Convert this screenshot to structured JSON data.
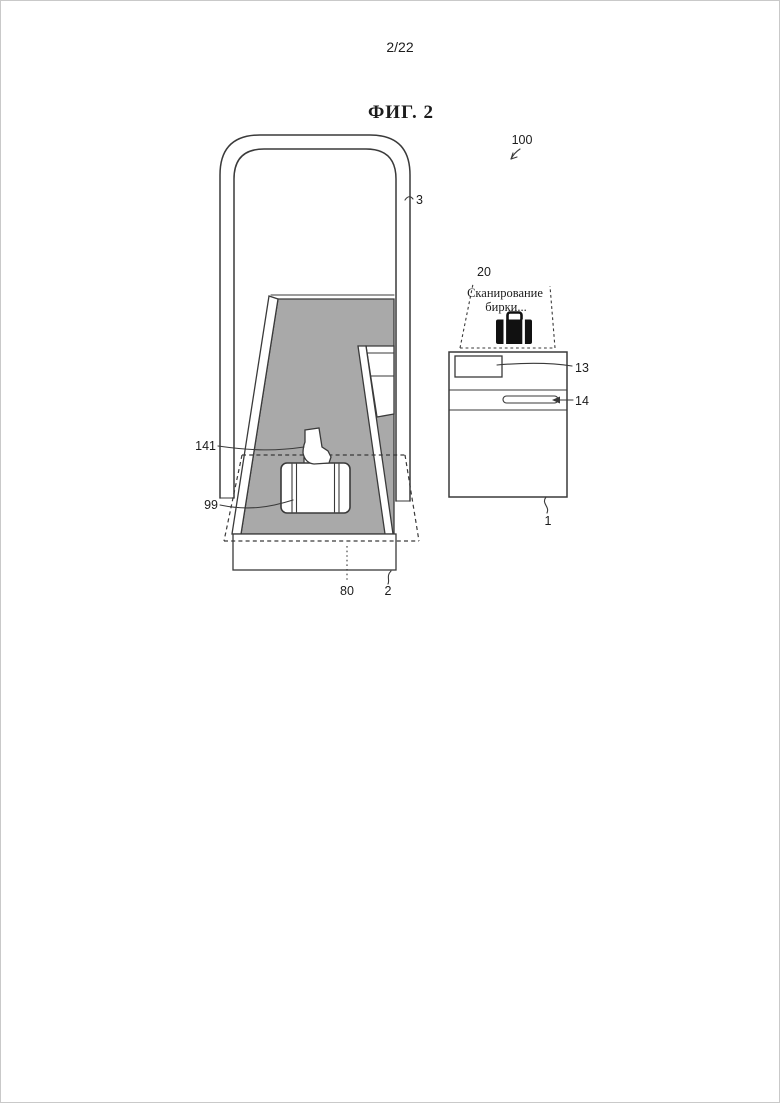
{
  "page": {
    "number": "2/22",
    "figure_title": "ФИГ. 2"
  },
  "figure": {
    "caption_line1": "Сканирование",
    "caption_line2": "бирки...",
    "labels": {
      "system": "100",
      "handle_frame": "3",
      "scan_area": "20",
      "display": "13",
      "slot": "14",
      "device_body": "1",
      "tag": "141",
      "baggage": "99",
      "scan_region": "80",
      "base": "2"
    }
  },
  "colors": {
    "line": "#3a3a3a",
    "gray": "#a9a9a9",
    "bg": "#ffffff",
    "ink": "#111111"
  }
}
